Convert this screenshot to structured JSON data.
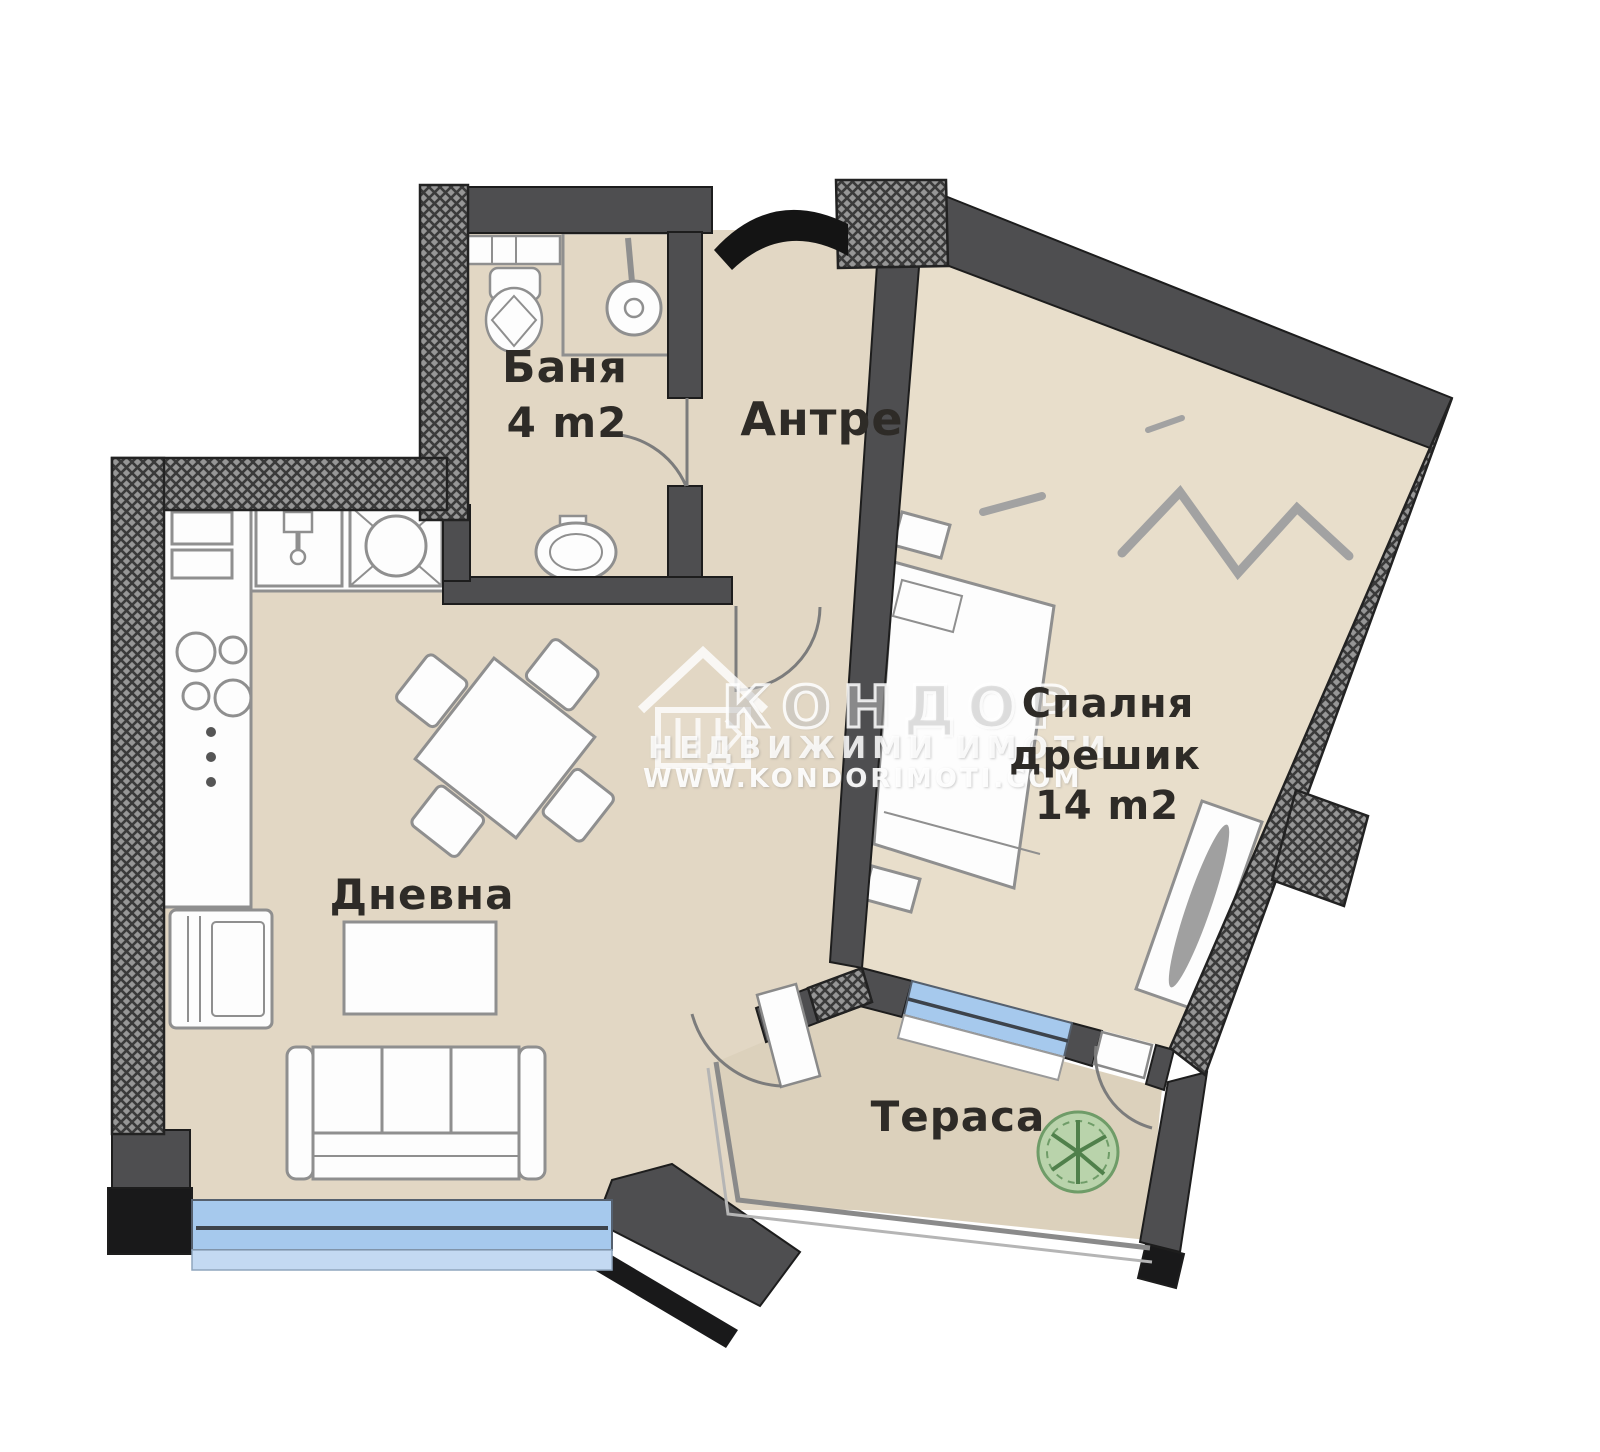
{
  "title": "Apartment floor plan",
  "rooms": {
    "bathroom": {
      "name": "Баня",
      "area": "4 m2"
    },
    "hallway": {
      "name": "Антре"
    },
    "bedroom": {
      "name": "Спалня",
      "name2": "дрешик",
      "area": "14 m2"
    },
    "living": {
      "name": "Дневна"
    },
    "terrace": {
      "name": "Тераса"
    }
  },
  "watermark": {
    "brand": "КОНДОР",
    "tagline": "НЕДВИЖИМИ ИМОТИ",
    "website": "WWW.KONDORIMOTI.COM"
  },
  "colors": {
    "floor": "#e2d7c4",
    "floor_bedroom": "#e8decb",
    "floor_terrace": "#dcd1bc",
    "wall": "#4e4e50",
    "wall_black": "#19191a",
    "hatch": "#969696",
    "hatch_line": "#3a3a3a",
    "line": "#8f8f8f",
    "window": "#a6c9ed",
    "window_light": "#c3d9f2",
    "plant": "#b9d3ab",
    "plant_dark": "#6f9c68",
    "text": "#2e2b27",
    "watermark": "rgba(255,255,255,0.82)"
  }
}
